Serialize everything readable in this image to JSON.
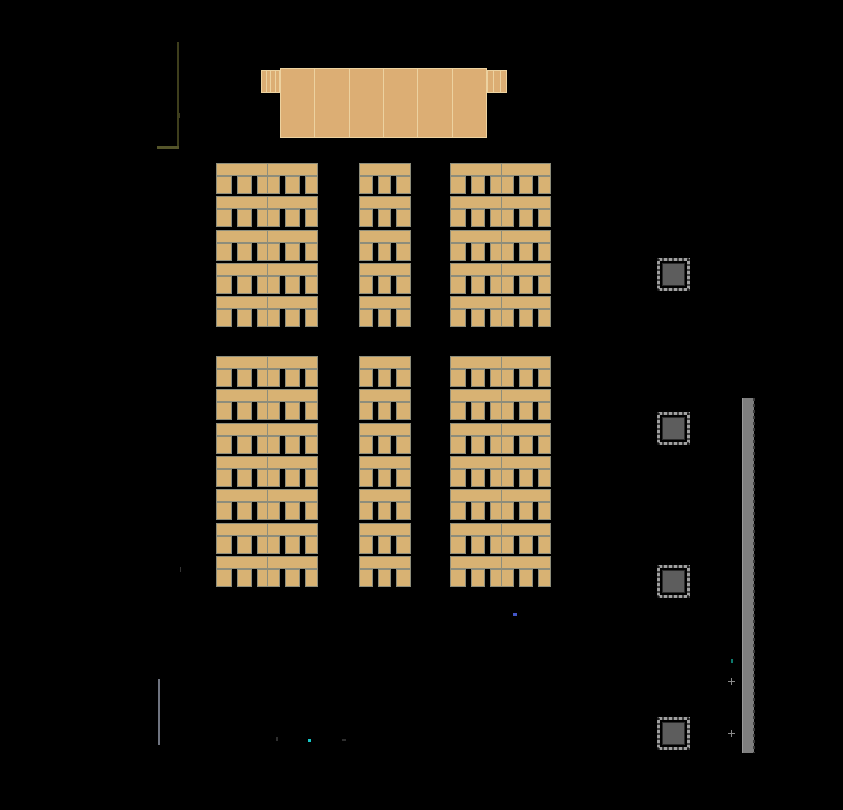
{
  "scene": {
    "kind": "cad-classroom-floor-plan",
    "canvas": {
      "width": 843,
      "height": 810,
      "background": "#000000"
    }
  },
  "colors": {
    "background": "#000000",
    "desk_fill": "#d8b273",
    "desk_edge": "#8d8d7b",
    "podium_fill": "#dcae74",
    "podium_line": "#ecd2a0",
    "pillar_frame": "#a0a0a0",
    "pillar_fill": "#5d5d5d",
    "bar_fill": "#7e7e7e",
    "cross_marker": "#8a8a8a"
  },
  "walls": [
    {
      "name": "wall-top-left-vertical",
      "x": 177,
      "y": 42,
      "w": 2,
      "h": 106,
      "color": "#3e3e1c"
    },
    {
      "name": "wall-top-left-horizontal",
      "x": 157,
      "y": 146,
      "w": 22,
      "h": 3,
      "color": "#55552a"
    },
    {
      "name": "wall-bottom-left-vertical",
      "x": 158,
      "y": 679,
      "w": 2,
      "h": 66,
      "color": "#6f7480"
    }
  ],
  "podium": {
    "body": {
      "x": 280,
      "y": 68,
      "w": 207,
      "h": 70,
      "cells": 6
    },
    "wings": [
      {
        "name": "lecture-table-left-wing",
        "x": 261,
        "y": 70,
        "w": 19,
        "h": 23,
        "cells": 4
      },
      {
        "name": "lecture-table-right-wing",
        "x": 487,
        "y": 70,
        "w": 20,
        "h": 23,
        "cells": 3
      }
    ]
  },
  "desks": {
    "columns": [
      {
        "id": "left",
        "x": 216,
        "width": 102,
        "kind": "double"
      },
      {
        "id": "center",
        "x": 359,
        "width": 52,
        "kind": "single"
      },
      {
        "id": "right",
        "x": 450,
        "width": 101,
        "kind": "double"
      }
    ],
    "groups": [
      {
        "id": "front-block",
        "y": 163,
        "rows": 5
      },
      {
        "id": "rear-block",
        "y": 356,
        "rows": 7
      }
    ],
    "row_pitch": 33.3,
    "unit_height": 31,
    "desk_band_height": 13,
    "chair_pattern_double": [
      16,
      5,
      14,
      5,
      23,
      5,
      14,
      5,
      13
    ],
    "chair_pattern_single": [
      26,
      11,
      24,
      11,
      28
    ]
  },
  "pillars": {
    "size": 33,
    "items": [
      {
        "x": 657,
        "y": 258
      },
      {
        "x": 657,
        "y": 412
      },
      {
        "x": 657,
        "y": 565
      },
      {
        "x": 657,
        "y": 717
      }
    ]
  },
  "side_bar": {
    "x": 742,
    "y": 398,
    "w": 12,
    "h": 355
  },
  "markers": [
    {
      "name": "blue-marker",
      "type": "dot",
      "x": 513,
      "y": 613,
      "w": 4,
      "h": 3,
      "color": "#4356c8"
    },
    {
      "name": "cyan-marker",
      "type": "dot",
      "x": 308,
      "y": 739,
      "w": 3,
      "h": 3,
      "color": "#16c8c8"
    },
    {
      "name": "teal-marker",
      "type": "dot",
      "x": 731,
      "y": 659,
      "w": 2,
      "h": 4,
      "color": "#0e7a6e"
    },
    {
      "name": "cross-marker-1",
      "type": "cross",
      "x": 728,
      "y": 678,
      "w": 7,
      "h": 7,
      "color": "#8a8a8a"
    },
    {
      "name": "cross-marker-2",
      "type": "cross",
      "x": 728,
      "y": 730,
      "w": 7,
      "h": 7,
      "color": "#8a8a8a"
    },
    {
      "name": "tick-1",
      "type": "dot",
      "x": 276,
      "y": 737,
      "w": 2,
      "h": 4,
      "color": "#2e2e2e"
    },
    {
      "name": "tick-2",
      "type": "dot",
      "x": 342,
      "y": 739,
      "w": 4,
      "h": 2,
      "color": "#2e2e2e"
    },
    {
      "name": "tick-3",
      "type": "dot",
      "x": 179,
      "y": 113,
      "w": 1,
      "h": 5,
      "color": "#3c3c20"
    },
    {
      "name": "tick-4",
      "type": "dot",
      "x": 180,
      "y": 567,
      "w": 1,
      "h": 5,
      "color": "#343434"
    }
  ]
}
